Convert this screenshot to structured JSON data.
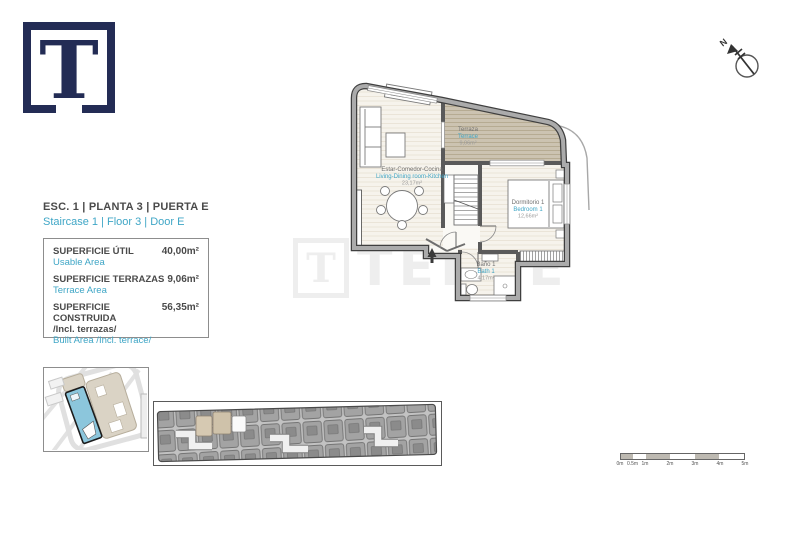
{
  "header": {
    "title_es": "ESC. 1 | PLANTA 3 | PUERTA E",
    "title_en": "Staircase 1 | Floor 3 | Door E"
  },
  "logo": {
    "letter": "T"
  },
  "compass": {
    "label": "N"
  },
  "watermark": {
    "letter": "T",
    "text": "TEKCE"
  },
  "areas_table": {
    "rows": [
      {
        "label_es": "SUPERFICIE ÚTIL",
        "label_en": "Usable Area",
        "value": "40,00m²"
      },
      {
        "label_es": "SUPERFICIE TERRAZAS",
        "label_en": "Terrace Area",
        "value": "9,06m²"
      },
      {
        "label_es": "SUPERFICIE CONSTRUIDA",
        "label_es2": "/Incl. terrazas/",
        "label_en": "Built Area /Incl. terrace/",
        "value": "56,35m²"
      }
    ]
  },
  "floor_plan": {
    "rooms": [
      {
        "name_es": "Terraza",
        "name_en": "Terrace",
        "area": "9,06m²"
      },
      {
        "name_es": "Estar-Comedor-Cocina",
        "name_en": "Living-Dining room-Kitchen",
        "area": "23,17m²"
      },
      {
        "name_es": "Dormitorio 1",
        "name_en": "Bedroom 1",
        "area": "12,66m²"
      },
      {
        "name_es": "Baño 1",
        "name_en": "Bath 1",
        "area": "4,17m²"
      }
    ]
  },
  "scale_bar": {
    "labels": [
      "0m",
      "0.5m",
      "1m",
      "2m",
      "3m",
      "4m",
      "5m"
    ]
  },
  "colors": {
    "navy": "#232c55",
    "blue_text": "#3fa6c6",
    "terrace_fill": "#ccc3b1",
    "highlight_building": "#8cc6dc"
  }
}
